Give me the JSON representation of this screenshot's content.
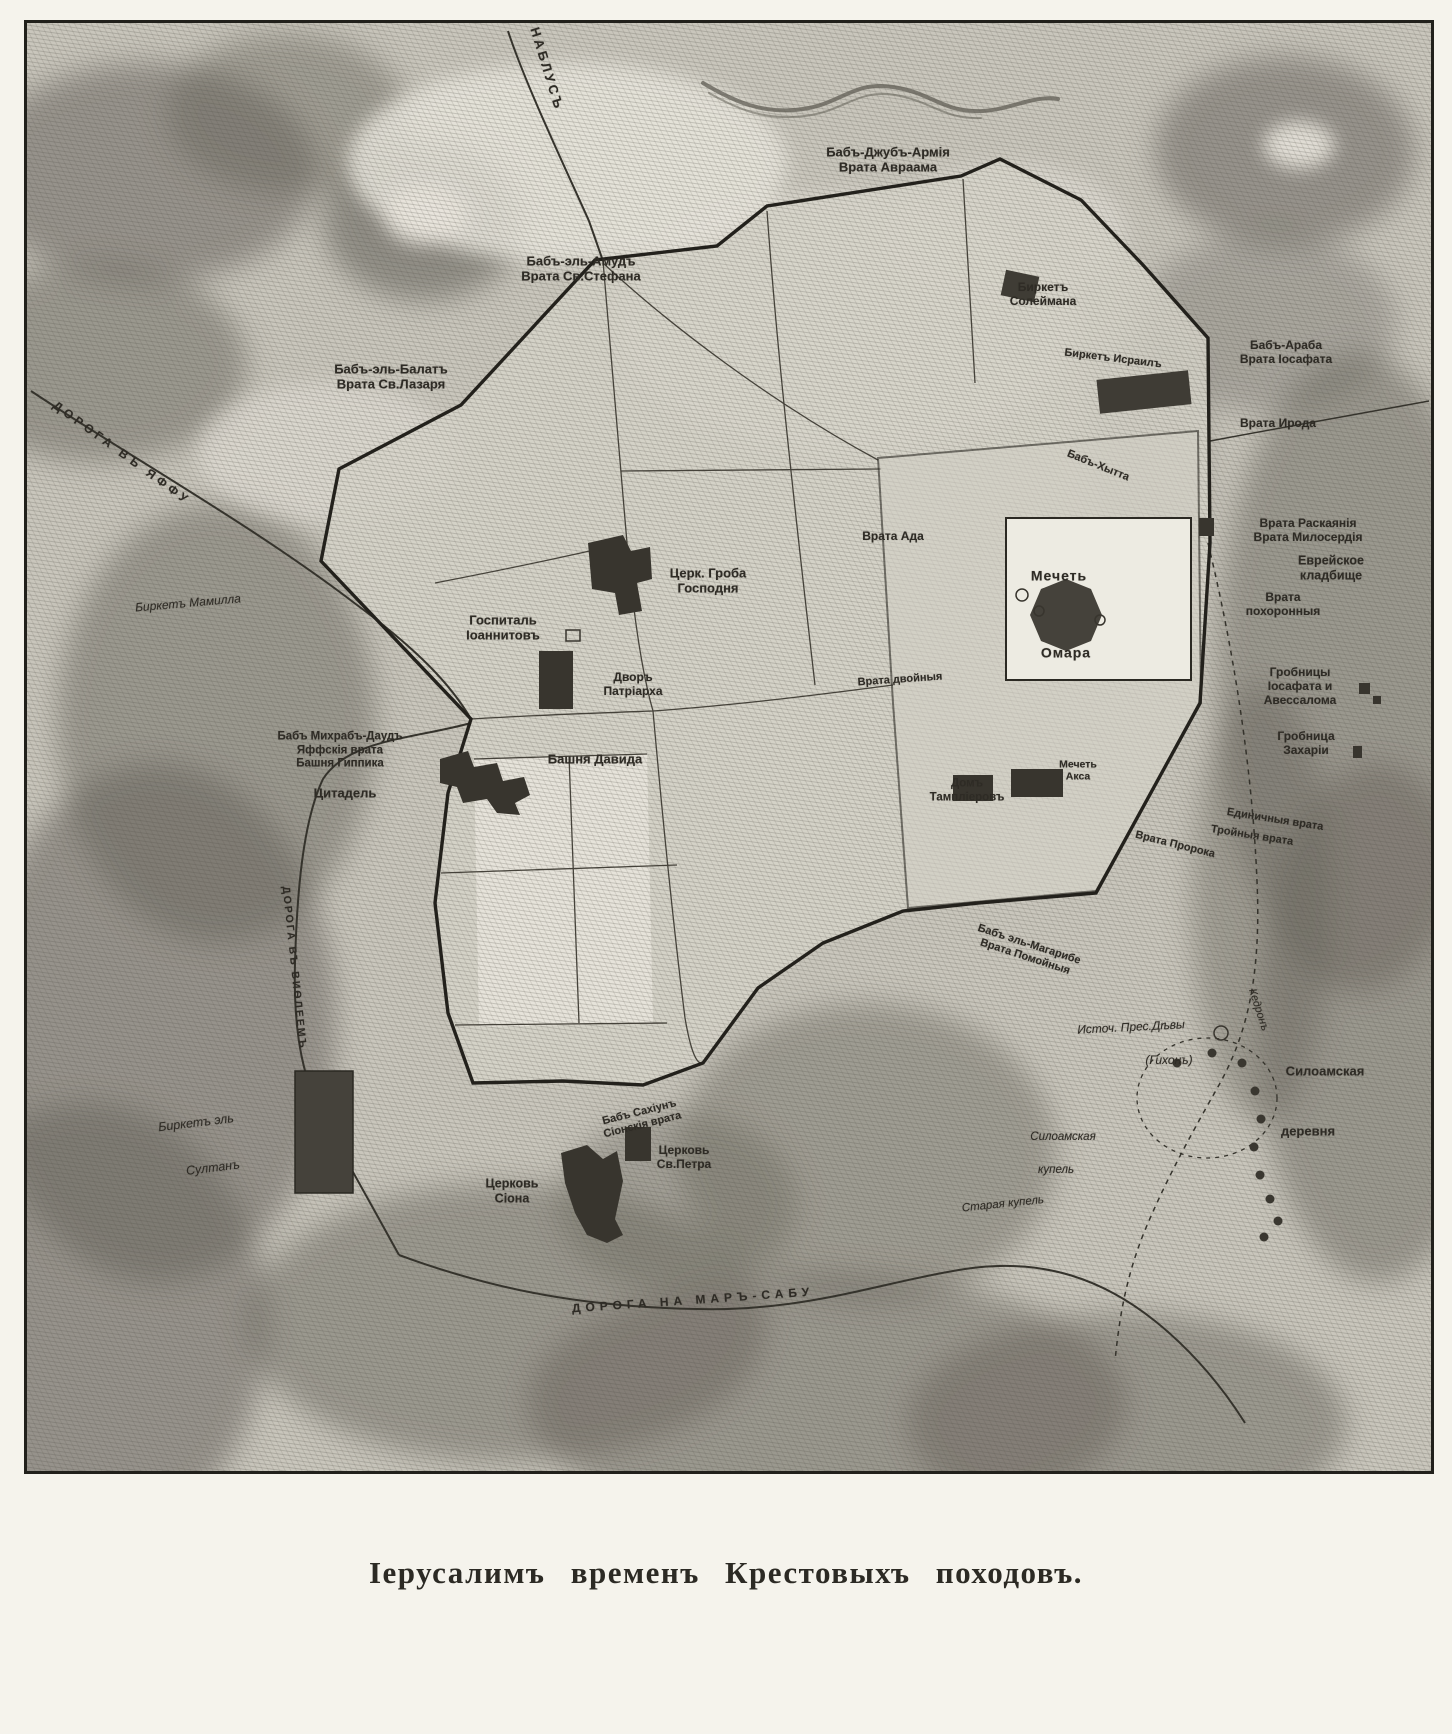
{
  "caption": "Іерусалимъ временъ Крестовыхъ походовъ.",
  "colors": {
    "paper": "#f5f3ec",
    "terrain_base": "#c9c6bc",
    "city_fill": "#d6d3c9",
    "platform_fill": "#edebe2",
    "ink": "#26241e",
    "label_ink": "#2e2b25"
  },
  "map": {
    "labels": [
      {
        "id": "road-nablus-label",
        "lines": [
          "НАБЛУСЪ"
        ],
        "x": 520,
        "y": 46,
        "rot": 73,
        "size": 13,
        "sp": 3
      },
      {
        "id": "gate-abraham",
        "lines": [
          "Бабъ-Джубъ-Армія",
          "Врата Авраама"
        ],
        "x": 861,
        "y": 137,
        "rot": 0,
        "size": 13
      },
      {
        "id": "gate-st-stephen",
        "lines": [
          "Бабъ-эль-Амудъ",
          "Врата Св.Стефана"
        ],
        "x": 554,
        "y": 246,
        "rot": 0,
        "size": 13
      },
      {
        "id": "gate-st-lazarus",
        "lines": [
          "Бабъ-эль-Балатъ",
          "Врата Св.Лазаря"
        ],
        "x": 364,
        "y": 354,
        "rot": 0,
        "size": 13
      },
      {
        "id": "road-jaffa-label",
        "lines": [
          "ДОРОГА ВЪ ЯФФУ"
        ],
        "x": 95,
        "y": 430,
        "rot": 36,
        "size": 12,
        "sp": 4
      },
      {
        "id": "pool-mamilla",
        "lines": [
          "Биркетъ Мамилла"
        ],
        "x": 161,
        "y": 580,
        "rot": -5,
        "size": 12,
        "it": true
      },
      {
        "id": "pool-suleiman",
        "lines": [
          "Биркетъ",
          "Солеймана"
        ],
        "x": 1016,
        "y": 271,
        "rot": 0,
        "size": 12
      },
      {
        "id": "gate-jehoshaphat",
        "lines": [
          "Бабъ-Араба",
          "Врата Іосафата"
        ],
        "x": 1259,
        "y": 329,
        "rot": 0,
        "size": 12
      },
      {
        "id": "gate-herod",
        "lines": [
          "Врата Ирода"
        ],
        "x": 1251,
        "y": 400,
        "rot": 0,
        "size": 12
      },
      {
        "id": "pool-israil",
        "lines": [
          "Биркетъ Исраилъ"
        ],
        "x": 1086,
        "y": 336,
        "rot": 7,
        "size": 11
      },
      {
        "id": "gate-hytta",
        "lines": [
          "Бабъ-Хытта"
        ],
        "x": 1071,
        "y": 443,
        "rot": 22,
        "size": 11
      },
      {
        "id": "gate-hell",
        "lines": [
          "Врата Ада"
        ],
        "x": 866,
        "y": 513,
        "rot": 0,
        "size": 12
      },
      {
        "id": "gate-repentance-mercy",
        "lines": [
          "Врата Раскаянія",
          "Врата Милосердія"
        ],
        "x": 1281,
        "y": 507,
        "rot": 0,
        "size": 12
      },
      {
        "id": "jewish-cemetery",
        "lines": [
          "Еврейское",
          "кладбище"
        ],
        "x": 1304,
        "y": 545,
        "rot": 0,
        "size": 12.5
      },
      {
        "id": "gate-funeral",
        "lines": [
          "Врата",
          "похоронныя"
        ],
        "x": 1256,
        "y": 581,
        "rot": 0,
        "size": 12
      },
      {
        "id": "church-holy-sepulchre",
        "lines": [
          "Церк. Гроба",
          "Господня"
        ],
        "x": 681,
        "y": 558,
        "rot": 0,
        "size": 13
      },
      {
        "id": "hospital-johannites",
        "lines": [
          "Госпиталь",
          "Іоаннитовъ"
        ],
        "x": 476,
        "y": 605,
        "rot": 0,
        "size": 13
      },
      {
        "id": "patriarch-court",
        "lines": [
          "Дворъ",
          "Патріарха"
        ],
        "x": 606,
        "y": 661,
        "rot": 0,
        "size": 12
      },
      {
        "id": "tombs-jehoshaphat-absalom",
        "lines": [
          "Гробницы",
          "Іосафата и",
          "Авессалома"
        ],
        "x": 1273,
        "y": 663,
        "rot": 0,
        "size": 12
      },
      {
        "id": "tomb-zechariah",
        "lines": [
          "Гробница",
          "Захаріи"
        ],
        "x": 1279,
        "y": 720,
        "rot": 0,
        "size": 12
      },
      {
        "id": "jaffa-gate",
        "lines": [
          "Бабъ Михрабъ-Даудъ",
          "Яффскія врата",
          "Башня Гиппика"
        ],
        "x": 313,
        "y": 728,
        "rot": 0,
        "size": 11.5
      },
      {
        "id": "tower-of-david",
        "lines": [
          "Башня Давида"
        ],
        "x": 568,
        "y": 736,
        "rot": 0,
        "size": 13
      },
      {
        "id": "citadel",
        "lines": [
          "Цитадель"
        ],
        "x": 318,
        "y": 770,
        "rot": 0,
        "size": 13
      },
      {
        "id": "gate-double",
        "lines": [
          "Врата двойныя"
        ],
        "x": 873,
        "y": 657,
        "rot": -4,
        "size": 11
      },
      {
        "id": "mosque-omar-line1",
        "lines": [
          "Мечеть"
        ],
        "x": 1032,
        "y": 553,
        "rot": 0,
        "size": 14,
        "sp": 1
      },
      {
        "id": "mosque-omar-line2",
        "lines": [
          "Омара"
        ],
        "x": 1039,
        "y": 630,
        "rot": 0,
        "size": 14,
        "sp": 1
      },
      {
        "id": "mosque-aqsa",
        "lines": [
          "Мечеть",
          "Акса"
        ],
        "x": 1051,
        "y": 748,
        "rot": 0,
        "size": 10.5
      },
      {
        "id": "templars-house",
        "lines": [
          "Домъ",
          "Тампліеровъ"
        ],
        "x": 940,
        "y": 768,
        "rot": 0,
        "size": 11.5
      },
      {
        "id": "gate-single",
        "lines": [
          "Единичныя врата"
        ],
        "x": 1248,
        "y": 797,
        "rot": 9,
        "size": 11
      },
      {
        "id": "gate-triple",
        "lines": [
          "Тройныя врата"
        ],
        "x": 1225,
        "y": 813,
        "rot": 9,
        "size": 11
      },
      {
        "id": "gate-prophet",
        "lines": [
          "Врата Пророка"
        ],
        "x": 1148,
        "y": 822,
        "rot": 14,
        "size": 11
      },
      {
        "id": "gate-dung",
        "lines": [
          "Бабъ эль-Магарибе",
          "Врата Помойныя"
        ],
        "x": 1000,
        "y": 928,
        "rot": 18,
        "size": 11
      },
      {
        "id": "road-bethlehem-label",
        "lines": [
          "ДОРОГА ВЪ ВИѲЛЕЕМЪ"
        ],
        "x": 267,
        "y": 945,
        "rot": 84,
        "size": 10.5,
        "sp": 2
      },
      {
        "id": "gate-zion",
        "lines": [
          "Бабъ Сахіунъ",
          "Сіонскія врата"
        ],
        "x": 614,
        "y": 1096,
        "rot": -14,
        "size": 11
      },
      {
        "id": "church-st-peter",
        "lines": [
          "Церковь",
          "Св.Петра"
        ],
        "x": 657,
        "y": 1134,
        "rot": 0,
        "size": 12
      },
      {
        "id": "church-zion",
        "lines": [
          "Церковь",
          "Сіона"
        ],
        "x": 485,
        "y": 1168,
        "rot": 0,
        "size": 12.5
      },
      {
        "id": "pool-sultan-line1",
        "lines": [
          "Биркетъ эль"
        ],
        "x": 169,
        "y": 1100,
        "rot": -7,
        "size": 12.5,
        "it": true
      },
      {
        "id": "pool-sultan-line2",
        "lines": [
          "Султанъ"
        ],
        "x": 186,
        "y": 1145,
        "rot": -7,
        "size": 12.5,
        "it": true
      },
      {
        "id": "spring-virgin",
        "lines": [
          "Источ. Прес.Дѣвы"
        ],
        "x": 1104,
        "y": 1004,
        "rot": -3,
        "size": 12,
        "it": true
      },
      {
        "id": "spring-gihon",
        "lines": [
          "(Гихонъ)"
        ],
        "x": 1142,
        "y": 1037,
        "rot": 0,
        "size": 12,
        "it": true
      },
      {
        "id": "kidron-valley",
        "lines": [
          "Кедронъ"
        ],
        "x": 1231,
        "y": 987,
        "rot": 72,
        "size": 11,
        "it": true
      },
      {
        "id": "siloam-village-line1",
        "lines": [
          "Силоамская"
        ],
        "x": 1298,
        "y": 1048,
        "rot": 0,
        "size": 13
      },
      {
        "id": "siloam-village-line2",
        "lines": [
          "деревня"
        ],
        "x": 1281,
        "y": 1108,
        "rot": 0,
        "size": 13
      },
      {
        "id": "siloam-pool-line1",
        "lines": [
          "Силоамская"
        ],
        "x": 1036,
        "y": 1115,
        "rot": 0,
        "size": 11.5,
        "it": true
      },
      {
        "id": "siloam-pool-line2",
        "lines": [
          "купель"
        ],
        "x": 1029,
        "y": 1148,
        "rot": 0,
        "size": 11.5,
        "it": true
      },
      {
        "id": "old-pool",
        "lines": [
          "Старая купель"
        ],
        "x": 976,
        "y": 1182,
        "rot": -6,
        "size": 11.5,
        "it": true
      },
      {
        "id": "road-marsaba-label",
        "lines": [
          "ДОРОГА НА МАРЪ-САБУ"
        ],
        "x": 666,
        "y": 1277,
        "rot": -4,
        "size": 12,
        "sp": 5
      }
    ]
  }
}
